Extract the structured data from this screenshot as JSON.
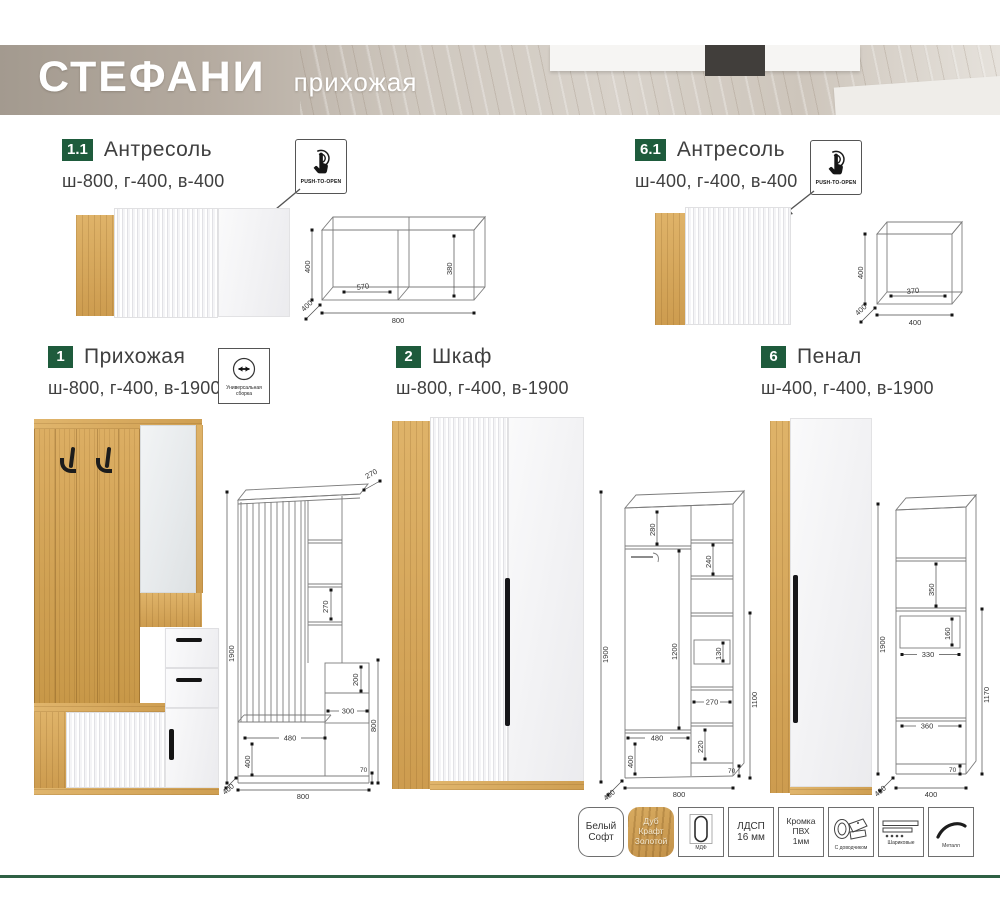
{
  "header": {
    "title": "СТЕФАНИ",
    "subtitle": "прихожая"
  },
  "items": {
    "antresol11": {
      "badge": "1.1",
      "name": "Антресоль",
      "dims": "ш-800, г-400, в-400",
      "feature": "PUSH-TO-OPEN"
    },
    "antresol61": {
      "badge": "6.1",
      "name": "Антресоль",
      "dims": "ш-400, г-400, в-400",
      "feature": "PUSH-TO-OPEN"
    },
    "prihozhaya": {
      "badge": "1",
      "name": "Прихожая",
      "dims": "ш-800, г-400, в-1900",
      "feature": "Универсальная\nсборка"
    },
    "shkaf": {
      "badge": "2",
      "name": "Шкаф",
      "dims": "ш-800, г-400, в-1900"
    },
    "penal": {
      "badge": "6",
      "name": "Пенал",
      "dims": "ш-400, г-400, в-1900"
    }
  },
  "drawings": {
    "antresol11": {
      "h": "400",
      "inner_h": "380",
      "inner_w": "570",
      "w": "800",
      "d": "400"
    },
    "antresol61": {
      "h": "400",
      "inner_w": "370",
      "w": "400",
      "d": "400"
    },
    "prihozhaya": {
      "total_h": "1900",
      "top_d": "270",
      "shelf_gap": "270",
      "drawer_h": "200",
      "drawer_w": "300",
      "bench_w": "480",
      "bench_h": "400",
      "right_h": "800",
      "plinth_h": "70",
      "w": "800",
      "d": "400"
    },
    "shkaf": {
      "total_h": "1900",
      "top_gap": "280",
      "shelf_gap": "240",
      "hang_h": "1200",
      "drawer_h": "130",
      "shelf_w": "270",
      "bottom_gap": "220",
      "left_h": "400",
      "bottom_w": "480",
      "right_h": "1100",
      "plinth_h": "70",
      "w": "800",
      "d": "400"
    },
    "penal": {
      "total_h": "1900",
      "shelf_gap": "350",
      "drawer_h": "160",
      "drawer_w": "330",
      "right_h": "1170",
      "shelf_w": "360",
      "plinth_h": "70",
      "w": "400",
      "d": "400"
    }
  },
  "materials": [
    {
      "label": "Белый\nСофт"
    },
    {
      "label": "Дуб\nКрафт\nЗолотой"
    },
    {
      "label": "МДФ"
    },
    {
      "label": "ЛДСП\n16 мм"
    },
    {
      "label": "Кромка\nПВХ\n1мм"
    },
    {
      "label": "С доводчиком"
    },
    {
      "label": "Шариковые"
    },
    {
      "label": "Металл"
    }
  ],
  "colors": {
    "badge_green": "#1e5b3c",
    "divider_green": "#2e6044",
    "wood": "#d5a558"
  }
}
